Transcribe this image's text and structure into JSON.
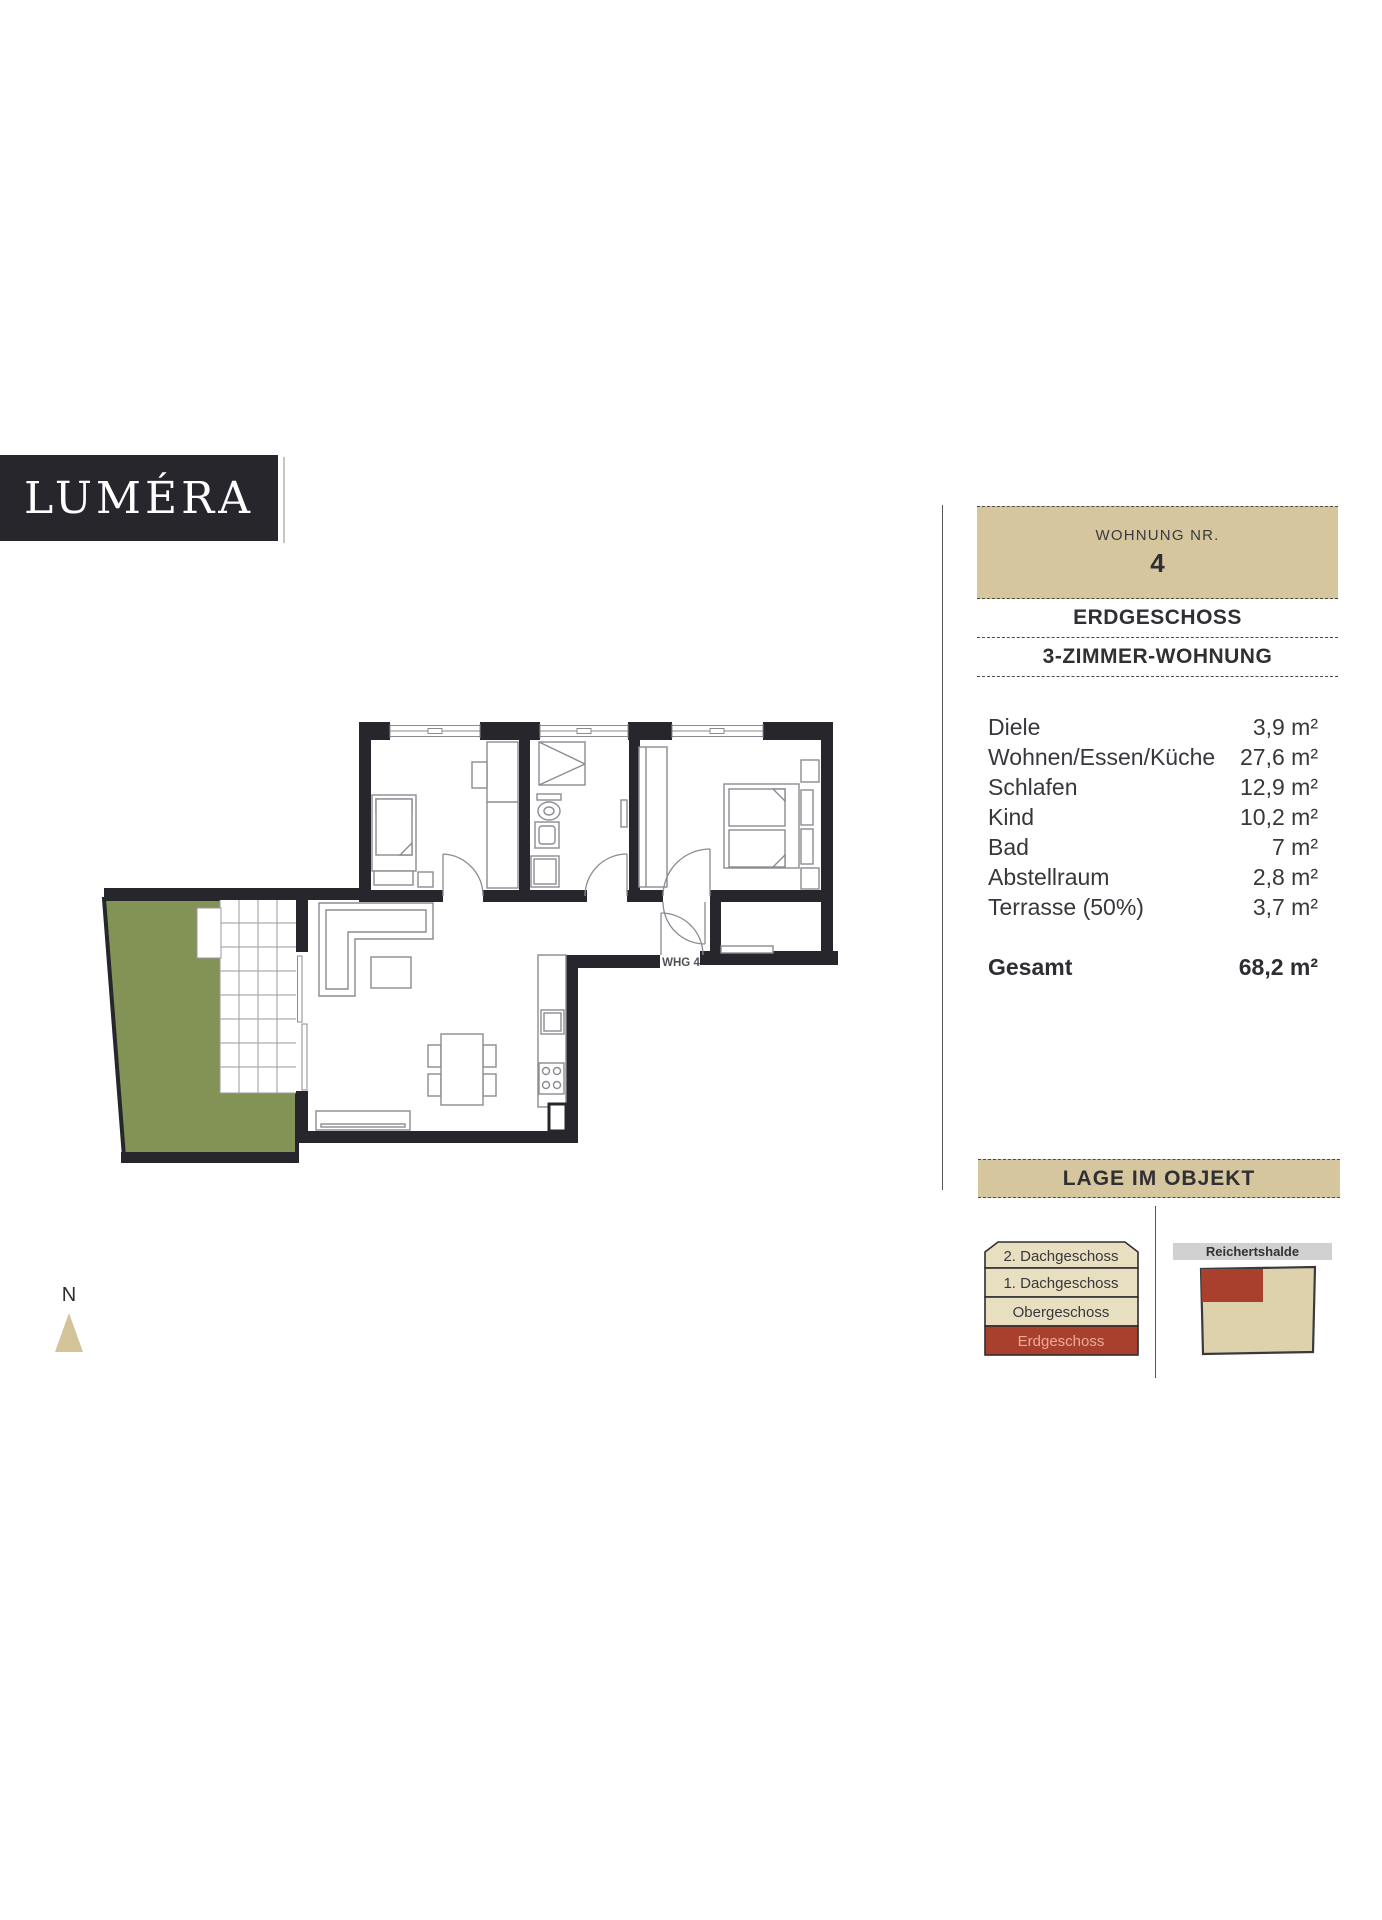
{
  "logo": {
    "text": "LUMÉRA"
  },
  "panel": {
    "unit_label": "WOHNUNG NR.",
    "unit_number": "4",
    "floor_title": "ERDGESCHOSS",
    "type_title": "3-ZIMMER-WOHNUNG",
    "rooms": [
      {
        "label": "Diele",
        "value": "3,9 m²"
      },
      {
        "label": "Wohnen/Essen/Küche",
        "value": "27,6 m²"
      },
      {
        "label": "Schlafen",
        "value": "12,9 m²"
      },
      {
        "label": "Kind",
        "value": "10,2 m²"
      },
      {
        "label": "Bad",
        "value": "7 m²"
      },
      {
        "label": "Abstellraum",
        "value": "2,8 m²"
      },
      {
        "label": "Terrasse (50%)",
        "value": "3,7 m²"
      }
    ],
    "total_label": "Gesamt",
    "total_value": "68,2 m²"
  },
  "lage": {
    "title": "LAGE IM OBJEKT",
    "floors": [
      "2. Dachgeschoss",
      "1. Dachgeschoss",
      "Obergeschoss",
      "Erdgeschoss"
    ],
    "highlighted_floor": "Erdgeschoss",
    "street_label": "Reichertshalde"
  },
  "plan": {
    "apartment_label": "WHG 4",
    "north_label": "N"
  },
  "colors": {
    "wall": "#26262c",
    "accent_tan": "#d5c69e",
    "stack_cream": "#e8dfc0",
    "building_tan": "#ddd2ab",
    "highlight_red": "#a8402d",
    "garden_green": "#829355"
  }
}
